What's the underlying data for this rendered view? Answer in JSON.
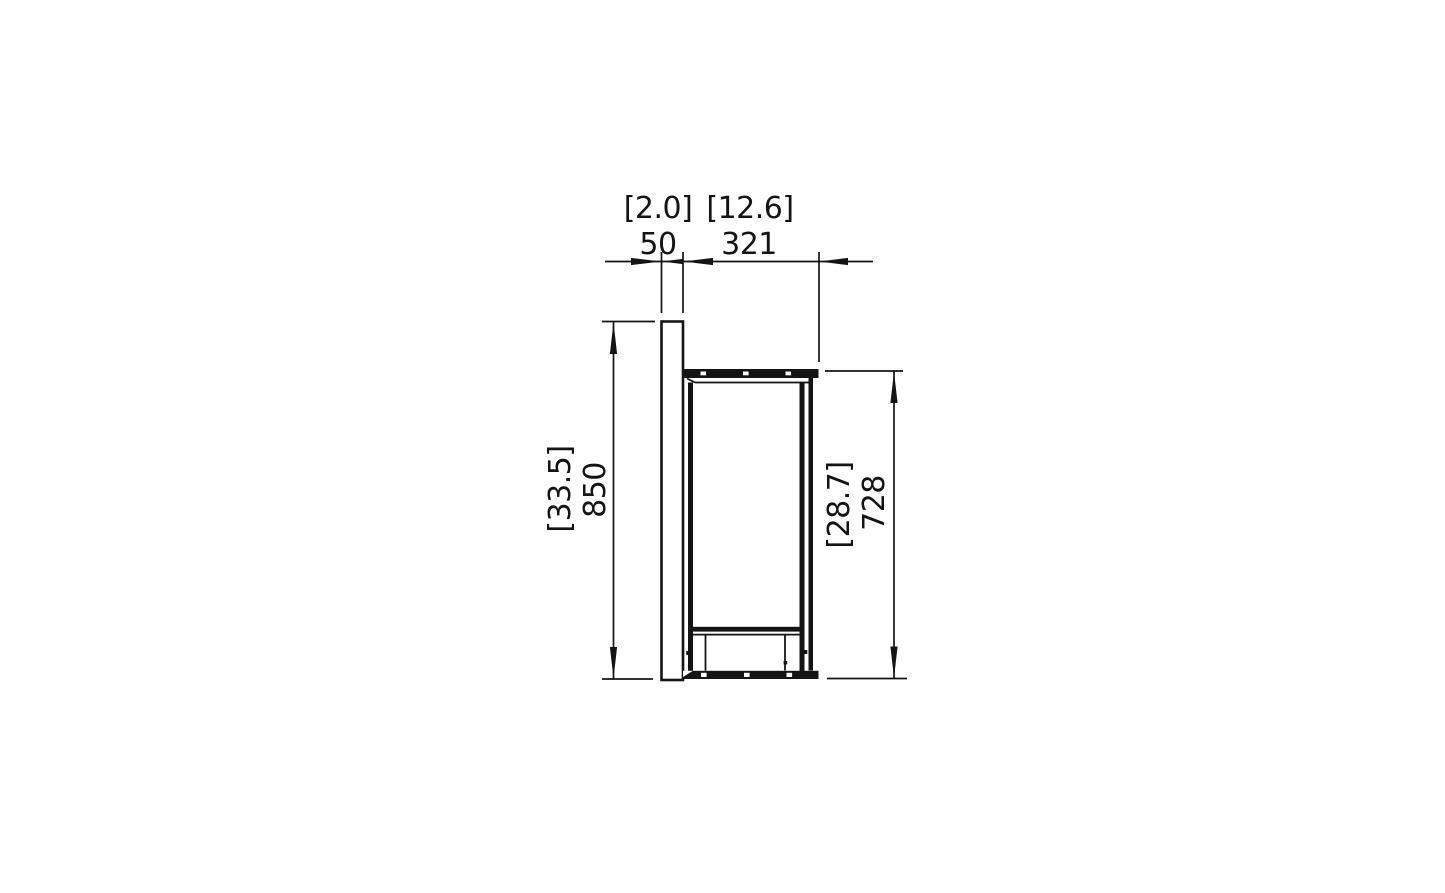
{
  "meta": {
    "background_color": "#ffffff",
    "line_color": "#141414",
    "view": "side elevation technical drawing"
  },
  "dimensions": {
    "top": [
      {
        "inches": "[2.0]",
        "mm": "50"
      },
      {
        "inches": "[12.6]",
        "mm": "321"
      }
    ],
    "left": {
      "inches": "[33.5]",
      "mm": "850"
    },
    "right": {
      "inches": "[28.7]",
      "mm": "728"
    }
  }
}
